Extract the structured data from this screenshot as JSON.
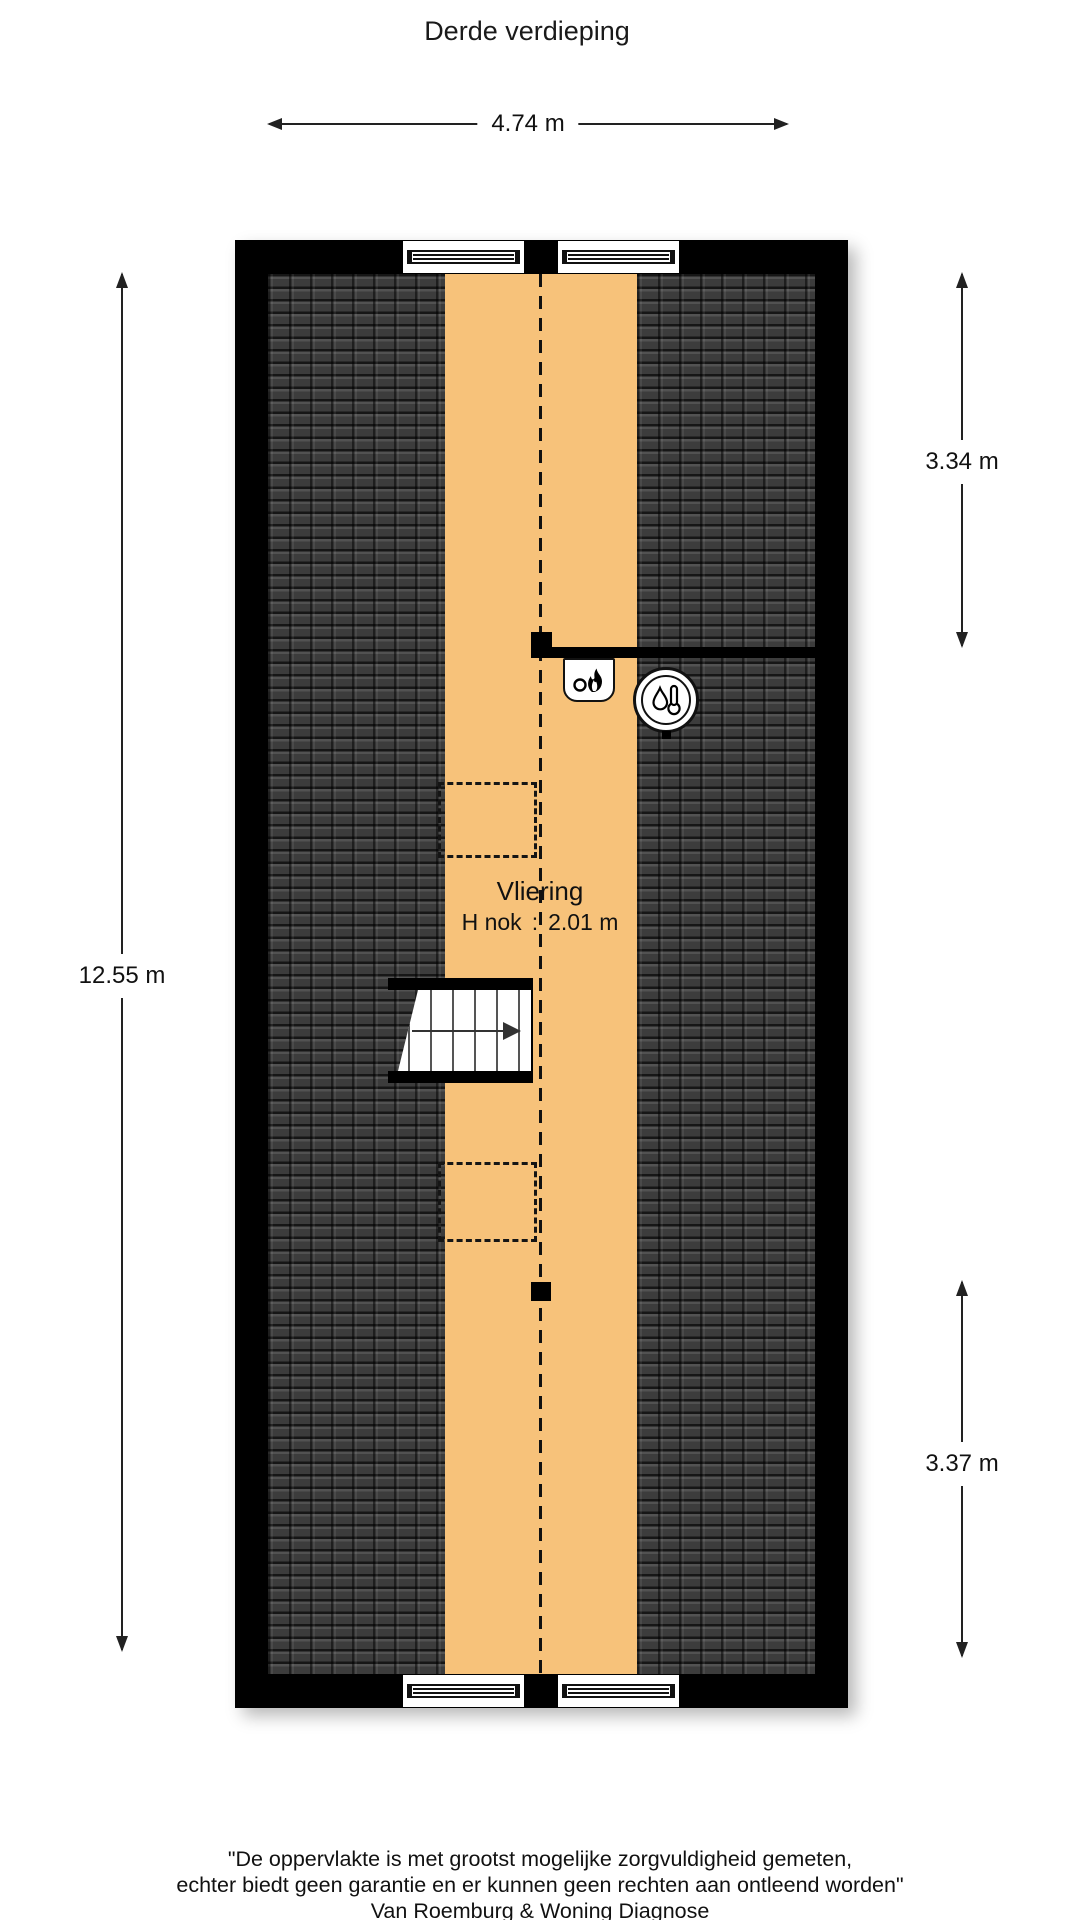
{
  "title": "Derde verdieping",
  "dimensions": {
    "width_top": "4.74 m",
    "height_left": "12.55 m",
    "height_right_upper": "3.34 m",
    "height_right_lower": "3.37 m"
  },
  "room": {
    "name": "Vliering",
    "ridge_height_label": "H nok",
    "ridge_height_separator": ":",
    "ridge_height_value": "2.01 m"
  },
  "icons": {
    "cv_unit": "flame-icon",
    "boiler": "droplet-thermometer-icon",
    "stairs": "stairs-up-arrow-icon"
  },
  "colors": {
    "floor": "#F7C27A",
    "roof_tiles": "#3A3A3A",
    "walls": "#000000"
  },
  "footer": {
    "line1": "\"De oppervlakte is met grootst mogelijke zorgvuldigheid gemeten,",
    "line2": "echter biedt geen garantie en er kunnen geen rechten aan ontleend worden\"",
    "line3": "Van Roemburg & Woning Diagnose"
  }
}
